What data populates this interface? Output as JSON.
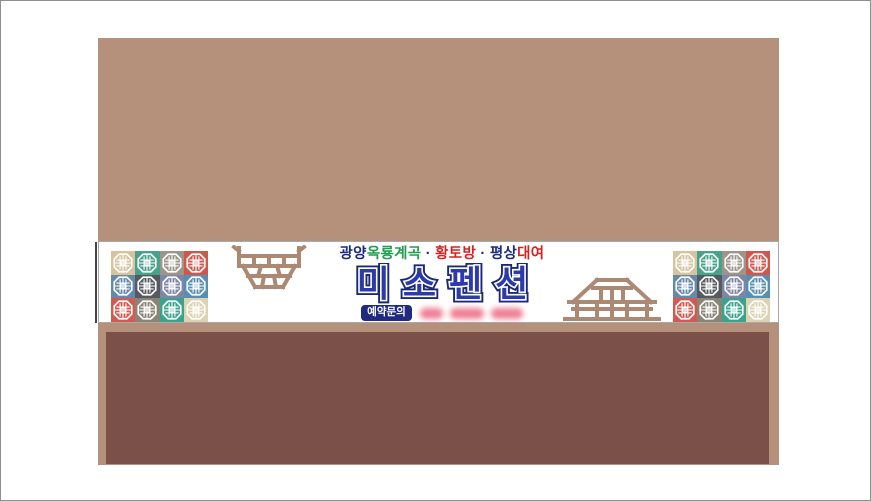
{
  "palette": {
    "upper_wall": "#b5917c",
    "lower_wall": "#7a5049",
    "ornament_brown": "#ab8973",
    "title_blue": "#2c3aac",
    "title_outline": "#1a2878",
    "badge_navy": "#1f2a80",
    "phone_pink": "#ee7f93",
    "tagline_navy": "#1c2b7d",
    "tagline_green": "#1e9e4e",
    "tagline_red": "#d42222"
  },
  "banner": {
    "tagline": {
      "segments": [
        {
          "text": "광양",
          "color": "#1c2b7d"
        },
        {
          "text": "옥룡계곡",
          "color": "#1e9e4e"
        },
        {
          "text": " · ",
          "color": "#1c2b7d"
        },
        {
          "text": "황토방",
          "color": "#d42222"
        },
        {
          "text": " · ",
          "color": "#1c2b7d"
        },
        {
          "text": "평상",
          "color": "#1c2b7d"
        },
        {
          "text": "대여",
          "color": "#d42222"
        }
      ]
    },
    "title": {
      "text": "미소펜션"
    },
    "contact": {
      "label": "예약문의",
      "phone_redacted": true,
      "redacted_groups": 3
    },
    "tiles": {
      "icon": "lattice-window-icon",
      "rows": 3,
      "cols": 4,
      "colors": [
        [
          "#d7c49e",
          "#47a28a",
          "#9d958a",
          "#cf574d"
        ],
        [
          "#6589ac",
          "#565a60",
          "#7d86a6",
          "#5590b4"
        ],
        [
          "#d35a50",
          "#8a8476",
          "#3aa38c",
          "#ddd2b2"
        ]
      ]
    },
    "ornaments": {
      "left": "pavilion-railing-icon",
      "right": "wooden-platform-icon"
    }
  }
}
